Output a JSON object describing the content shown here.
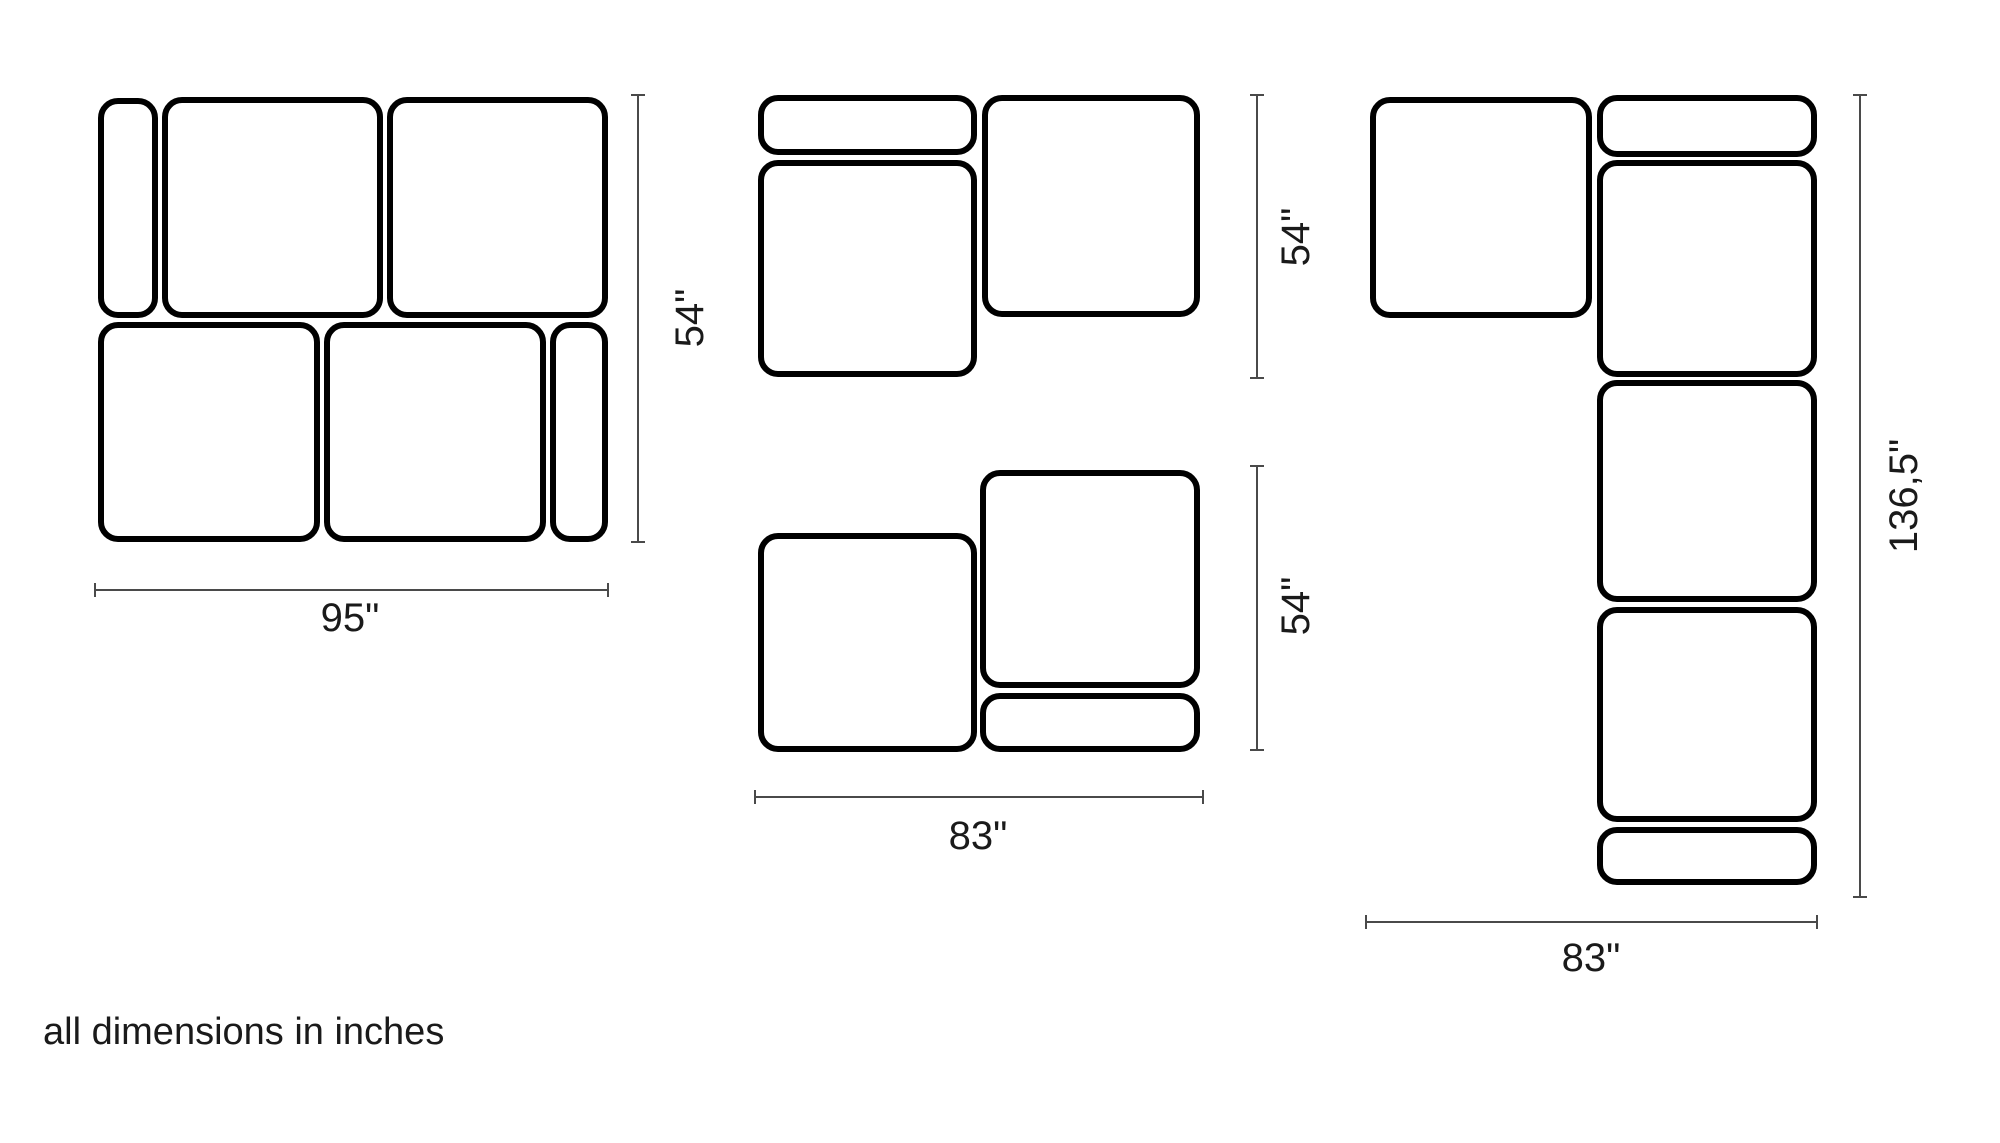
{
  "footnote": "all dimensions in inches",
  "units": "inches",
  "colors": {
    "background": "#ffffff",
    "module_outline": "#000000",
    "dimension_line": "#4a4a4a",
    "label_text": "#1a1a1a"
  },
  "configurations": [
    {
      "name": "sofa-configuration-95x54",
      "overall_width": "95\"",
      "overall_depth": "54\"",
      "modules": [
        {
          "name": "narrow-module-top-left",
          "x": 98,
          "y": 98,
          "w": 60,
          "h": 220
        },
        {
          "name": "seat-module",
          "x": 162,
          "y": 97,
          "w": 221,
          "h": 221
        },
        {
          "name": "seat-module",
          "x": 387,
          "y": 97,
          "w": 221,
          "h": 221
        },
        {
          "name": "seat-module",
          "x": 98,
          "y": 322,
          "w": 222,
          "h": 220
        },
        {
          "name": "seat-module",
          "x": 324,
          "y": 322,
          "w": 222,
          "h": 220
        },
        {
          "name": "narrow-module-bottom-right",
          "x": 550,
          "y": 322,
          "w": 58,
          "h": 220
        }
      ],
      "dimensions": [
        {
          "orientation": "v",
          "x": 638,
          "y1": 95,
          "y2": 542,
          "label": "54\"",
          "label_x": 690,
          "label_y": 318
        },
        {
          "orientation": "h",
          "y": 590,
          "x1": 95,
          "x2": 608,
          "label": "95\"",
          "label_x": 350,
          "label_y": 618
        }
      ]
    },
    {
      "name": "sofa-configuration-chaise-54",
      "overall_depth": "54\"",
      "modules": [
        {
          "name": "narrow-module-top",
          "x": 758,
          "y": 95,
          "w": 219,
          "h": 60
        },
        {
          "name": "seat-module",
          "x": 758,
          "y": 160,
          "w": 219,
          "h": 217
        },
        {
          "name": "seat-module-square",
          "x": 982,
          "y": 95,
          "w": 218,
          "h": 222
        }
      ],
      "dimensions": [
        {
          "orientation": "v",
          "x": 1257,
          "y1": 95,
          "y2": 378,
          "label": "54\"",
          "label_x": 1296,
          "label_y": 237
        }
      ]
    },
    {
      "name": "sofa-configuration-83x54",
      "overall_width": "83\"",
      "overall_depth": "54\"",
      "modules": [
        {
          "name": "seat-module-square",
          "x": 758,
          "y": 533,
          "w": 219,
          "h": 219
        },
        {
          "name": "seat-module",
          "x": 980,
          "y": 470,
          "w": 220,
          "h": 218
        },
        {
          "name": "narrow-module-bottom",
          "x": 980,
          "y": 693,
          "w": 220,
          "h": 59
        }
      ],
      "dimensions": [
        {
          "orientation": "v",
          "x": 1257,
          "y1": 466,
          "y2": 750,
          "label": "54\"",
          "label_x": 1296,
          "label_y": 606
        },
        {
          "orientation": "h",
          "y": 797,
          "x1": 755,
          "x2": 1203,
          "label": "83\"",
          "label_x": 978,
          "label_y": 836
        }
      ]
    },
    {
      "name": "sofa-configuration-corner-83x136",
      "overall_width": "83\"",
      "overall_depth": "136,5\"",
      "modules": [
        {
          "name": "seat-module-corner",
          "x": 1370,
          "y": 97,
          "w": 222,
          "h": 221
        },
        {
          "name": "narrow-module-top",
          "x": 1597,
          "y": 95,
          "w": 220,
          "h": 62
        },
        {
          "name": "seat-module",
          "x": 1597,
          "y": 160,
          "w": 220,
          "h": 217
        },
        {
          "name": "seat-module",
          "x": 1597,
          "y": 380,
          "w": 220,
          "h": 222
        },
        {
          "name": "seat-module",
          "x": 1597,
          "y": 607,
          "w": 220,
          "h": 215
        },
        {
          "name": "narrow-module-bottom",
          "x": 1597,
          "y": 827,
          "w": 220,
          "h": 58
        }
      ],
      "dimensions": [
        {
          "orientation": "v",
          "x": 1860,
          "y1": 95,
          "y2": 897,
          "label": "136,5\"",
          "label_x": 1904,
          "label_y": 496
        },
        {
          "orientation": "h",
          "y": 922,
          "x1": 1366,
          "x2": 1817,
          "label": "83\"",
          "label_x": 1591,
          "label_y": 958
        }
      ]
    }
  ]
}
